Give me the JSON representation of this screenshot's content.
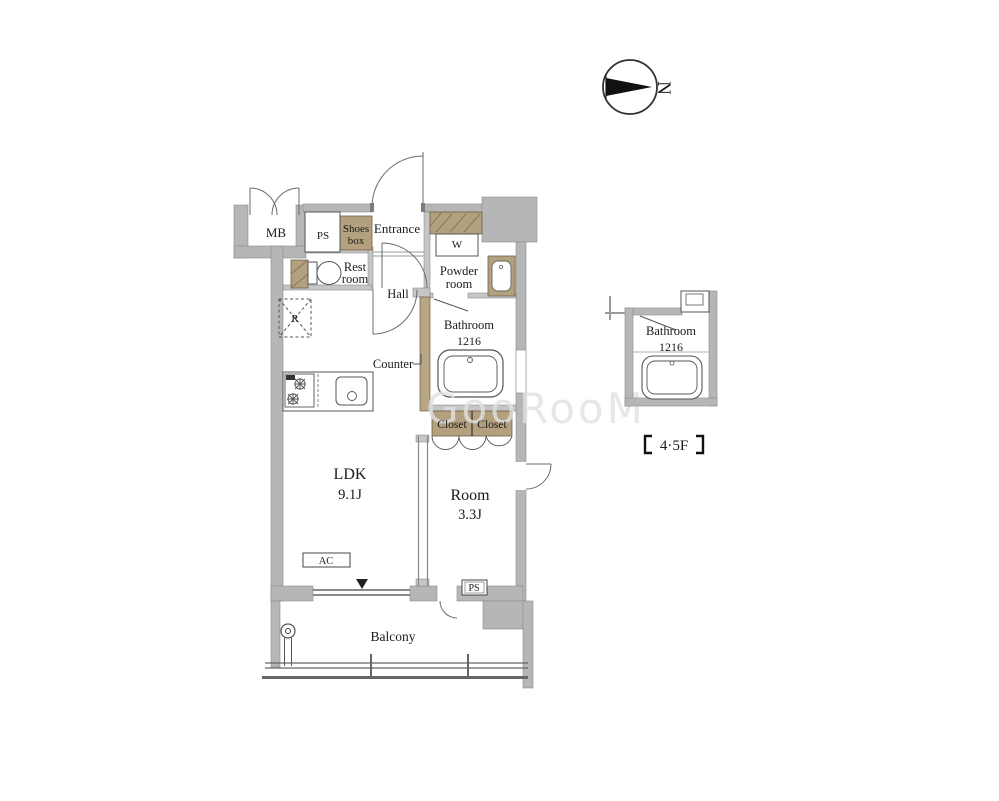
{
  "floorplan": {
    "rooms": {
      "mb": "MB",
      "ps_top": "PS",
      "shoes_box_line1": "Shoes",
      "shoes_box_line2": "box",
      "entrance": "Entrance",
      "washer": "W",
      "rest_room_line1": "Rest",
      "rest_room_line2": "room",
      "powder_room_line1": "Powder",
      "powder_room_line2": "room",
      "hall": "Hall",
      "refrigerator": "R",
      "bathroom_line1": "Bathroom",
      "bathroom_line2": "1216",
      "counter": "Counter",
      "closet_left": "Closet",
      "closet_right": "Closet",
      "ldk_line1": "LDK",
      "ldk_line2": "9.1J",
      "room_line1": "Room",
      "room_line2": "3.3J",
      "ac": "AC",
      "ps_bottom": "PS",
      "balcony": "Balcony"
    },
    "inset": {
      "bathroom_line1": "Bathroom",
      "bathroom_line2": "1216",
      "floor_label": "【4・5F】",
      "floor_label_core": "4·5F"
    },
    "compass": {
      "north": "N"
    },
    "watermark": "GooRooM",
    "colors": {
      "background": "#ffffff",
      "wall": "#b6b6b6",
      "partition": "#c6c6c6",
      "tan": "#b3a07f",
      "line": "#555555",
      "text": "#1b1b1b"
    }
  }
}
